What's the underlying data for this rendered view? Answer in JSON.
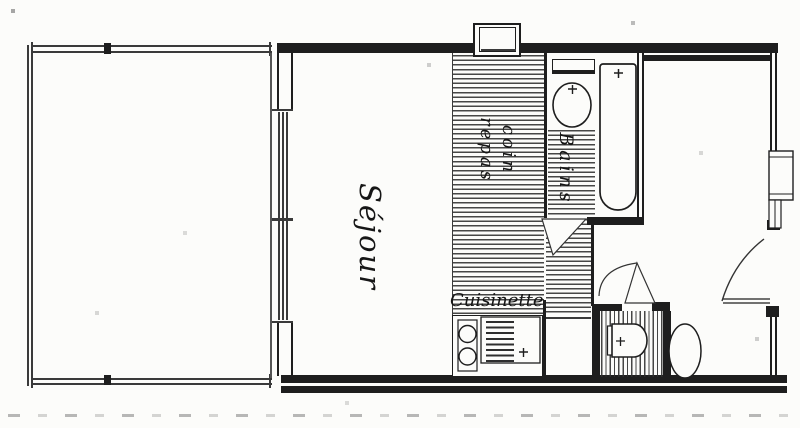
{
  "plan": {
    "description": "Hand-drawn studio apartment floor plan (scanned sketch)",
    "colors": {
      "ink": "#1e1e1e",
      "paper": "#fcfcfa",
      "hatch_line": "#2e2e2e",
      "artifact": "#8f8f8f"
    },
    "rooms": {
      "sejour": {
        "label": "Séjour"
      },
      "coin_repas": {
        "label_line1": "coin",
        "label_line2": "repas"
      },
      "bains": {
        "label": "Bains"
      },
      "cuisinette": {
        "label": "Cuisinette"
      }
    }
  }
}
